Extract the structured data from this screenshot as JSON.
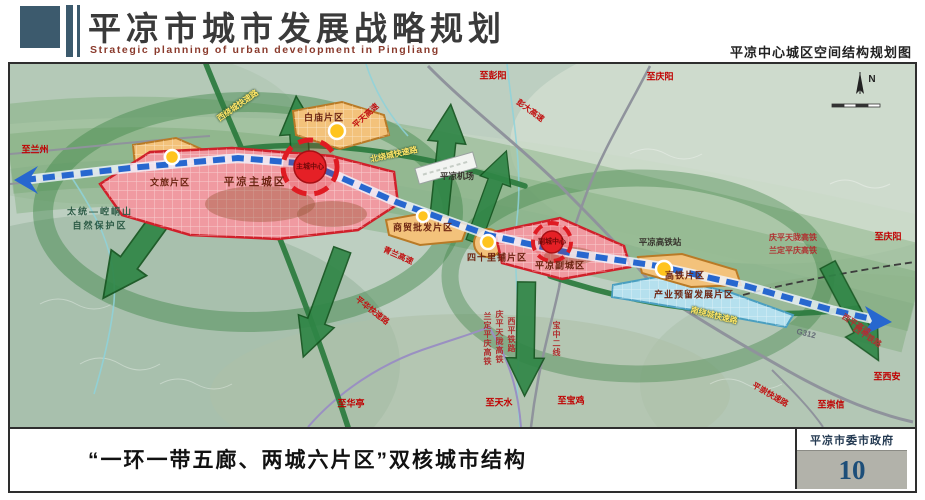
{
  "header": {
    "title": "平凉市城市发展战略规划",
    "subtitle": "Strategic planning of urban development in Pingliang",
    "map_title": "平凉中心城区空间结构规划图"
  },
  "footer": {
    "caption": "“一环一带五廊、两城六片区”双核城市结构",
    "organization": "平凉市委市政府",
    "page_number": "10"
  },
  "colors": {
    "brand_slate": "#3c5a6d",
    "axis_blue": "#2767cf",
    "core_red": "#e52026",
    "zone_pink": "#f09aa1",
    "zone_orange": "#f3c27b",
    "zone_cyan": "#b5e0ee",
    "eco_green": "#2f8546",
    "page_number_blue": "#1d4e79"
  },
  "map": {
    "labels": [
      {
        "t": "平凉主城区",
        "x": 245,
        "y": 118,
        "cls": "zone lg",
        "name": "zone-label-main-city"
      },
      {
        "t": "平凉副城区",
        "x": 550,
        "y": 202,
        "cls": "zone",
        "name": "zone-label-sub-city"
      },
      {
        "t": "白庙片区",
        "x": 314,
        "y": 54,
        "cls": "zone",
        "name": "zone-label-baimiao"
      },
      {
        "t": "文旅片区",
        "x": 160,
        "y": 119,
        "cls": "zone",
        "name": "zone-label-wenlv"
      },
      {
        "t": "商贸批发片区",
        "x": 413,
        "y": 164,
        "cls": "zone",
        "name": "zone-label-shangmao"
      },
      {
        "t": "四十里铺片区",
        "x": 487,
        "y": 194,
        "cls": "zone",
        "name": "zone-label-sishilipu"
      },
      {
        "t": "高铁片区",
        "x": 675,
        "y": 212,
        "cls": "zone",
        "name": "zone-label-gaotie"
      },
      {
        "t": "产业预留发展片区",
        "x": 684,
        "y": 231,
        "cls": "zone",
        "name": "zone-label-industry-reserve"
      },
      {
        "t": "主城中心",
        "x": 300,
        "y": 103,
        "cls": "core",
        "name": "core-label-main"
      },
      {
        "t": "副城中心",
        "x": 542,
        "y": 178,
        "cls": "core",
        "name": "core-label-sub"
      },
      {
        "t": "平凉机场",
        "x": 447,
        "y": 112,
        "cls": "poi",
        "name": "poi-label-airport"
      },
      {
        "t": "平凉高铁站",
        "x": 650,
        "y": 178,
        "cls": "poi",
        "name": "poi-label-hsr-station"
      },
      {
        "t": "西绕城快速路",
        "x": 228,
        "y": 42,
        "rot": -35,
        "cls": "road-y",
        "name": "road-label-west-ring"
      },
      {
        "t": "北绕城快速路",
        "x": 384,
        "y": 91,
        "rot": -12,
        "cls": "road-y",
        "name": "road-label-north-ring"
      },
      {
        "t": "南绕城快速路",
        "x": 704,
        "y": 252,
        "rot": 14,
        "cls": "road-y",
        "name": "road-label-south-ring"
      },
      {
        "t": "平天高速",
        "x": 356,
        "y": 52,
        "rot": -42,
        "cls": "road-r",
        "name": "road-label-pingtian-expwy"
      },
      {
        "t": "彭大高速",
        "x": 520,
        "y": 47,
        "rot": 36,
        "cls": "road-r",
        "name": "road-label-pengda-expwy"
      },
      {
        "t": "青兰高速",
        "x": 388,
        "y": 192,
        "rot": 24,
        "cls": "road-r",
        "name": "road-label-qinglan-expwy"
      },
      {
        "t": "平华快速路",
        "x": 362,
        "y": 247,
        "rot": 38,
        "cls": "road-r",
        "name": "road-label-pinghua-expwy"
      },
      {
        "t": "平崇快速路",
        "x": 760,
        "y": 331,
        "rot": 30,
        "cls": "road-r",
        "name": "road-label-pingchong-expwy"
      },
      {
        "t": "G312",
        "x": 796,
        "y": 270,
        "rot": 14,
        "cls": "road-g",
        "name": "road-label-g312"
      },
      {
        "t": "庆平天陇高铁",
        "x": 783,
        "y": 174,
        "cls": "rail",
        "name": "rail-label-qingping-hsr"
      },
      {
        "t": "兰定平庆高铁",
        "x": 783,
        "y": 187,
        "cls": "rail",
        "name": "rail-label-landing-hsr"
      },
      {
        "t": "西平高速",
        "x": 846,
        "y": 261,
        "rot": 33,
        "cls": "rail",
        "name": "road-label-xiping-expwy"
      },
      {
        "t": "西平铁路",
        "x": 857,
        "y": 273,
        "rot": 33,
        "cls": "rail",
        "name": "rail-label-xiping-east"
      },
      {
        "t": "兰定平庆高铁",
        "x": 477,
        "y": 275,
        "cls": "rail-v",
        "name": "rail-label-landing-v"
      },
      {
        "t": "庆平天陇高铁",
        "x": 489,
        "y": 273,
        "cls": "rail-v",
        "name": "rail-label-qingping-v"
      },
      {
        "t": "西平铁路",
        "x": 501,
        "y": 271,
        "cls": "rail-v",
        "name": "rail-label-xiping-v"
      },
      {
        "t": "宝中二线",
        "x": 546,
        "y": 275,
        "cls": "rail-v",
        "name": "rail-label-baozhong"
      },
      {
        "t": "至兰州",
        "x": 25,
        "y": 86,
        "cls": "dest",
        "name": "dest-label-lanzhou"
      },
      {
        "t": "至彭阳",
        "x": 483,
        "y": 12,
        "cls": "dest",
        "name": "dest-label-pengyang"
      },
      {
        "t": "至庆阳",
        "x": 650,
        "y": 13,
        "cls": "dest",
        "name": "dest-label-qingyang-north"
      },
      {
        "t": "至庆阳",
        "x": 878,
        "y": 173,
        "cls": "dest",
        "name": "dest-label-qingyang-east"
      },
      {
        "t": "至西安",
        "x": 877,
        "y": 313,
        "cls": "dest",
        "name": "dest-label-xian"
      },
      {
        "t": "至崇信",
        "x": 821,
        "y": 341,
        "cls": "dest",
        "name": "dest-label-chongxin"
      },
      {
        "t": "至华亭",
        "x": 341,
        "y": 340,
        "cls": "dest",
        "name": "dest-label-huating"
      },
      {
        "t": "至天水",
        "x": 489,
        "y": 339,
        "cls": "dest",
        "name": "dest-label-tianshui"
      },
      {
        "t": "至宝鸡",
        "x": 561,
        "y": 337,
        "cls": "dest",
        "name": "dest-label-baoji"
      },
      {
        "t": "太统—崆峒山",
        "x": 90,
        "y": 148,
        "cls": "reserve",
        "name": "reserve-label-line1"
      },
      {
        "t": "自然保护区",
        "x": 90,
        "y": 162,
        "cls": "reserve",
        "name": "reserve-label-line2"
      },
      {
        "t": "N",
        "x": 862,
        "y": 16,
        "cls": "compass",
        "name": "compass-n-label"
      }
    ]
  }
}
